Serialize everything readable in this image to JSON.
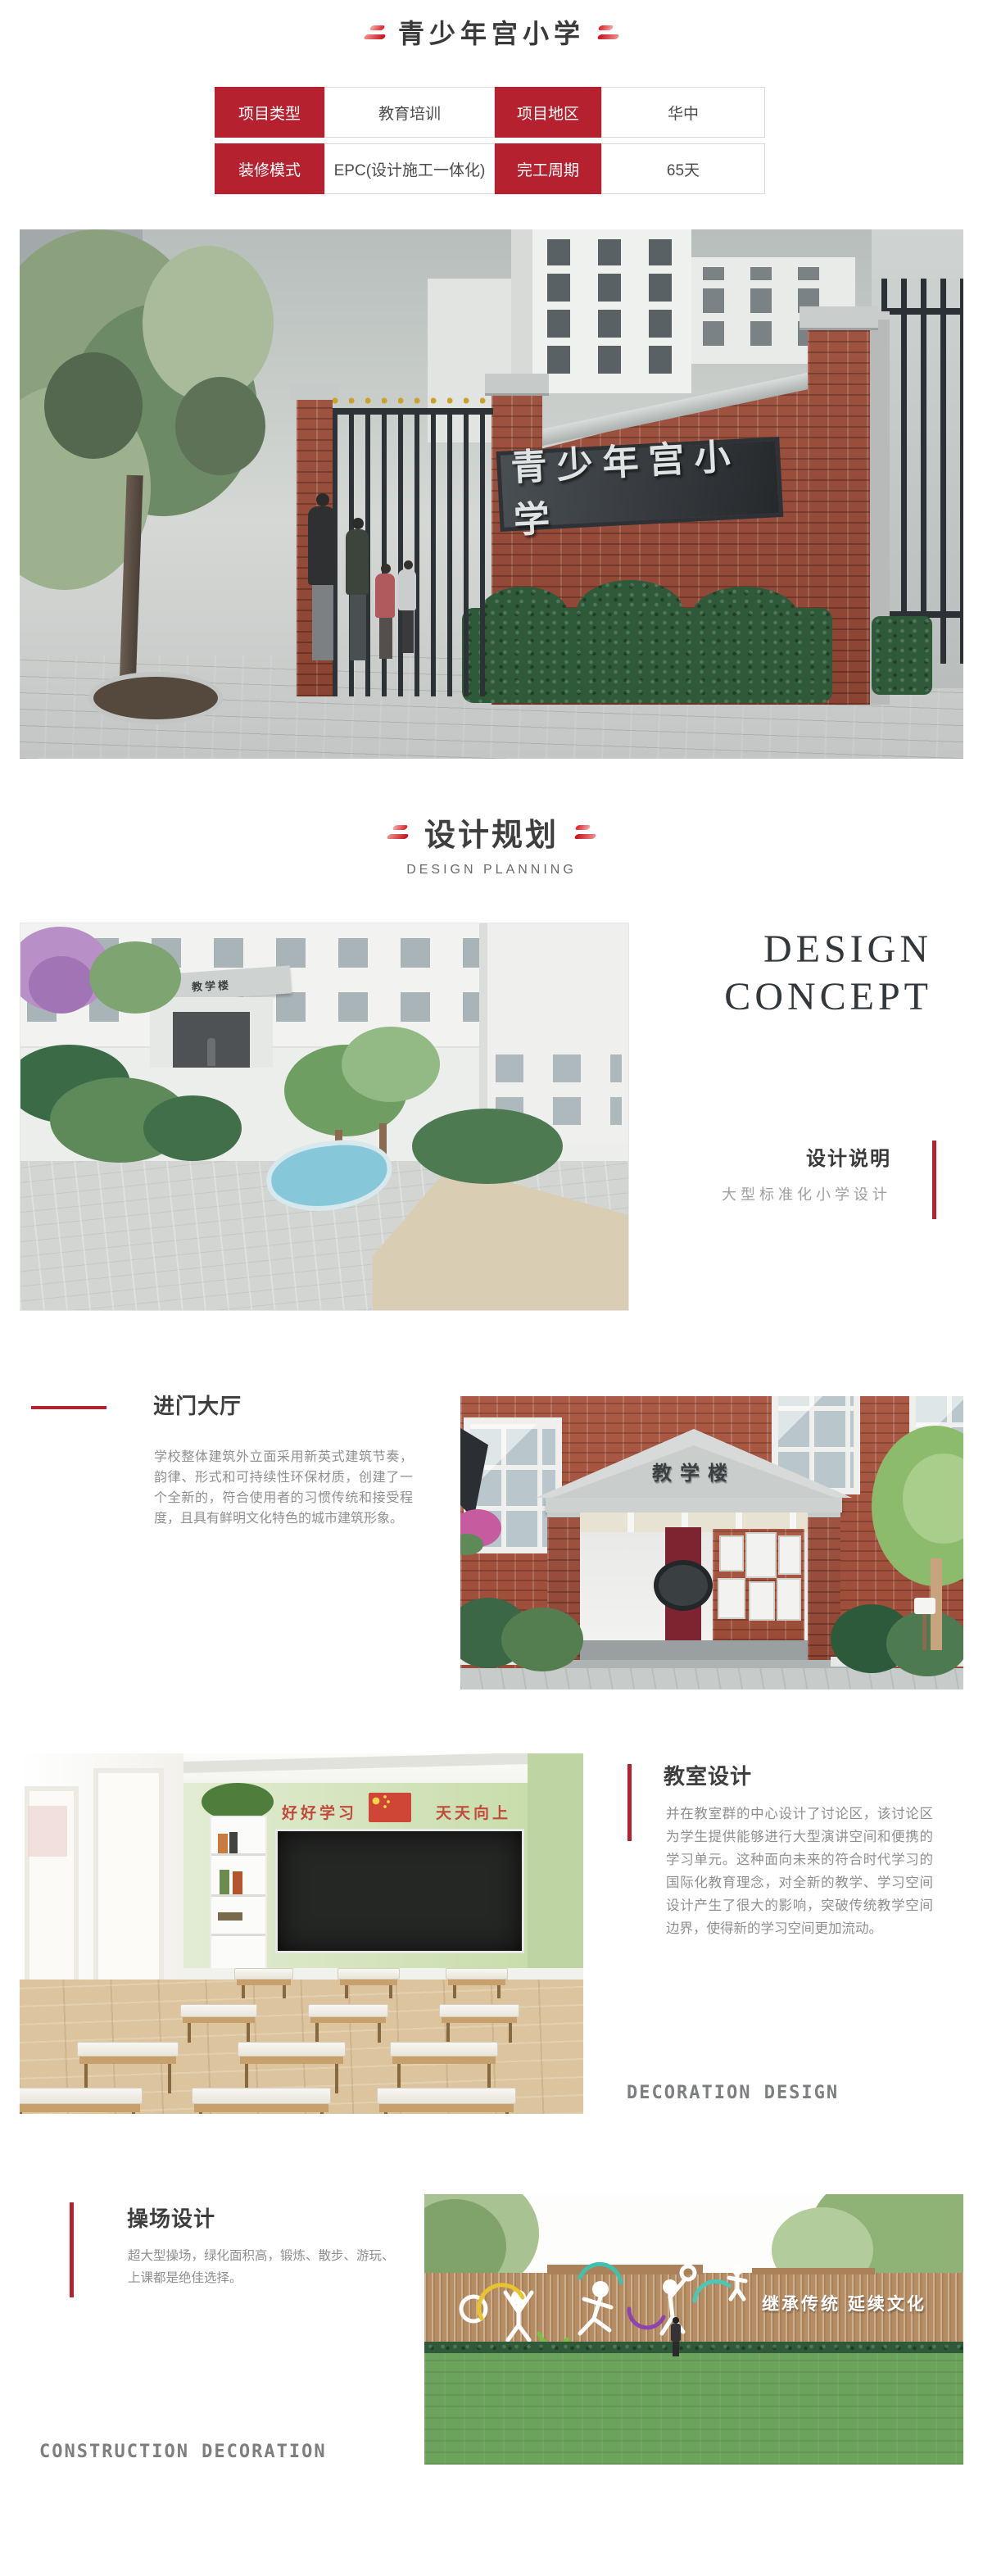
{
  "header": {
    "title": "青少年宫小学"
  },
  "info_table": {
    "r1c1": "项目类型",
    "r1c2": "教育培训",
    "r1c3": "项目地区",
    "r1c4": "华中",
    "r2c1": "装修模式",
    "r2c2": "EPC(设计施工一体化)",
    "r2c3": "完工周期",
    "r2c4": "65天"
  },
  "hero": {
    "sign_text": "青少年宫小学"
  },
  "planning": {
    "title": "设计规划",
    "subtitle": "DESIGN PLANNING"
  },
  "concept": {
    "heading_line1": "DESIGN",
    "heading_line2": "CONCEPT",
    "note_title": "设计说明",
    "note_text": "大型标准化小学设计",
    "building_sign": "教学楼"
  },
  "hall": {
    "title": "进门大厅",
    "body": "学校整体建筑外立面采用新英式建筑节奏，韵律、形式和可持续性环保材质，创建了一个全新的，符合使用者的习惯传统和接受程度，且具有鲜明文化特色的城市建筑形象。",
    "building_sign": "教学楼"
  },
  "classroom": {
    "title": "教室设计",
    "body": "并在教室群的中心设计了讨论区，该讨论区为学生提供能够进行大型演讲空间和便携的学习单元。这种面向未来的符合时代学习的国际化教育理念，对全新的教学、学习空间设计产生了很大的影响，突破传统教学空间边界，使得新的学习空间更加流动。",
    "banner_left": "好好学习",
    "banner_right": "天天向上",
    "footer_label": "DECORATION DESIGN"
  },
  "playground": {
    "title": "操场设计",
    "body": "超大型操场，绿化面积高，锻炼、散步、游玩、上课都是绝佳选择。",
    "wall_text": "继承传统 延续文化",
    "footer_label": "CONSTRUCTION DECORATION"
  },
  "colors": {
    "accent_red": "#b5212f",
    "sign_panel": "#2b2f32",
    "lawn_green": "#6ba25c"
  }
}
